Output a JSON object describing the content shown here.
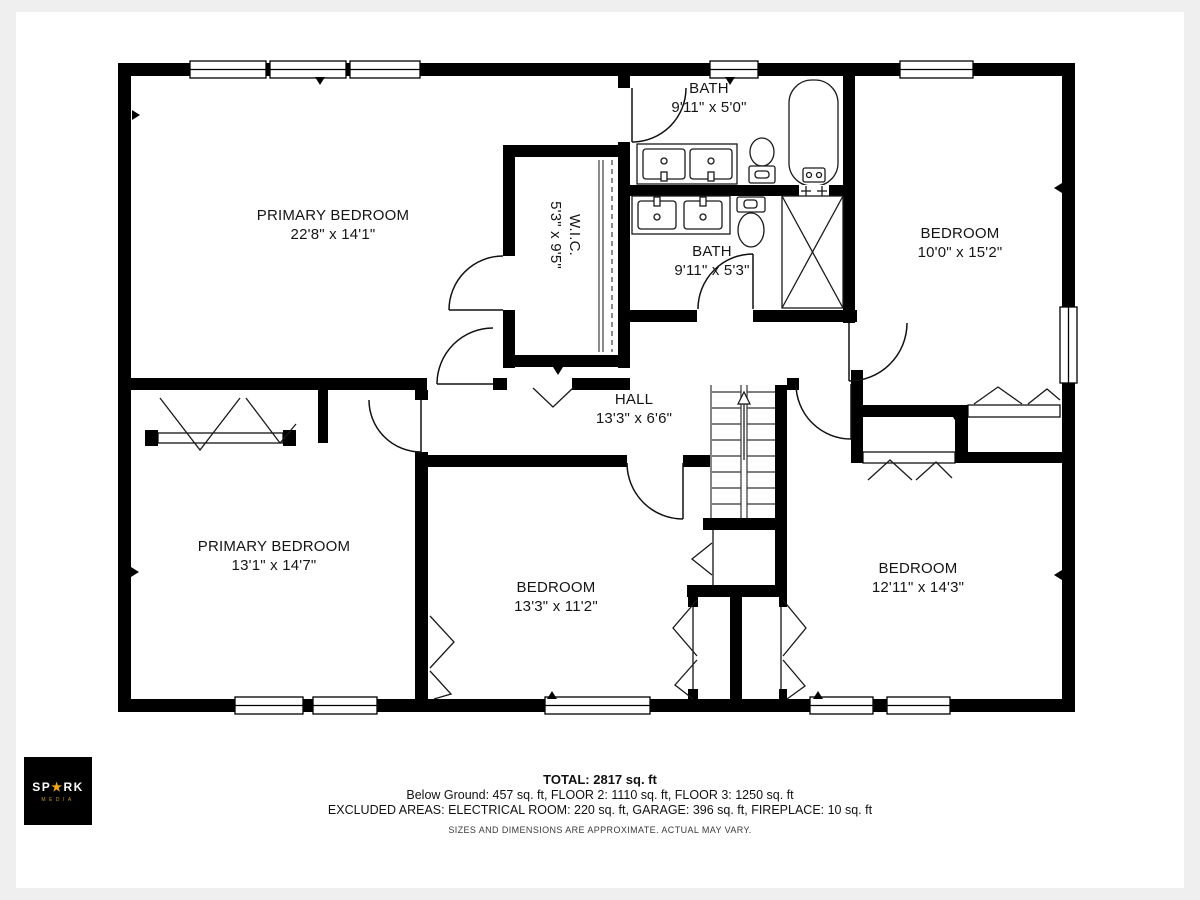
{
  "rooms": {
    "primary_top": {
      "name": "PRIMARY BEDROOM",
      "dims": "22'8\" x 14'1\""
    },
    "wic": {
      "name": "W.I.C.",
      "dims": "5'3\" x 9'5\""
    },
    "bath_top": {
      "name": "BATH",
      "dims": "9'11\" x 5'0\""
    },
    "bath_mid": {
      "name": "BATH",
      "dims": "9'11\" x 5'3\""
    },
    "bedroom_top_right": {
      "name": "BEDROOM",
      "dims": "10'0\" x 15'2\""
    },
    "hall": {
      "name": "HALL",
      "dims": "13'3\" x 6'6\""
    },
    "primary_bottom": {
      "name": "PRIMARY BEDROOM",
      "dims": "13'1\" x 14'7\""
    },
    "bedroom_bottom_middle": {
      "name": "BEDROOM",
      "dims": "13'3\" x 11'2\""
    },
    "bedroom_bottom_right": {
      "name": "BEDROOM",
      "dims": "12'11\" x 14'3\""
    }
  },
  "summary": {
    "total": "TOTAL: 2817 sq. ft",
    "floors": "Below Ground: 457 sq. ft, FLOOR 2: 1110 sq. ft, FLOOR 3: 1250 sq. ft",
    "excluded": "EXCLUDED AREAS: ELECTRICAL ROOM: 220 sq. ft, GARAGE: 396 sq. ft, FIREPLACE: 10 sq. ft",
    "disclaimer": "SIZES AND DIMENSIONS ARE APPROXIMATE. ACTUAL MAY VARY."
  },
  "logo": {
    "brand_pre": "SP",
    "star": "★",
    "brand_post": "RK",
    "subtext": "MEDIA"
  },
  "colors": {
    "wall": "#000000",
    "accent_star": "#f0a818",
    "page_bg": "#efefef",
    "canvas_bg": "#ffffff"
  }
}
